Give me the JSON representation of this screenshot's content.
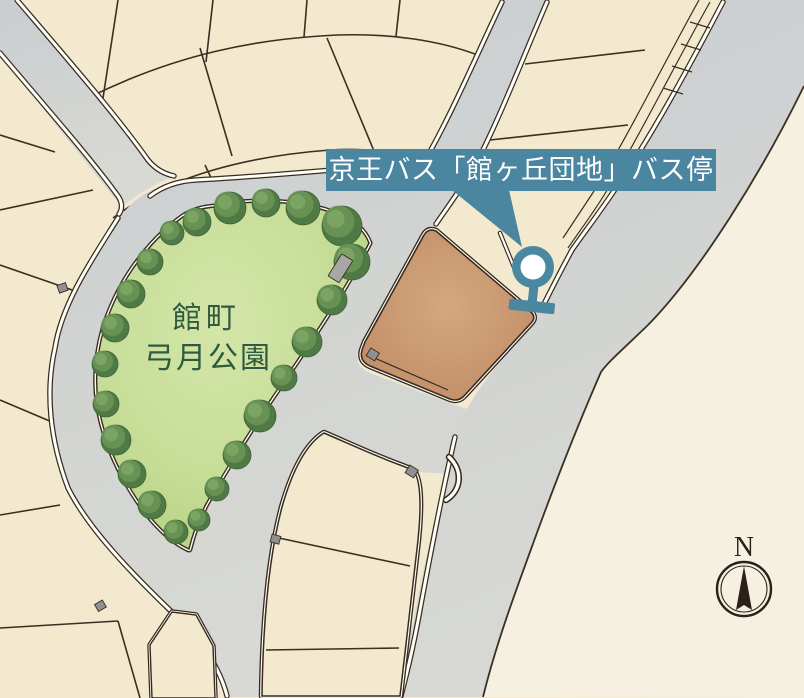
{
  "map": {
    "bus_stop_callout": {
      "label": "京王バス「館ヶ丘団地」バス停"
    },
    "park": {
      "name_line1": "館町",
      "name_line2": "弓月公園"
    },
    "compass": {
      "north_label": "N"
    },
    "colors": {
      "callout_teal": "#4a86a0",
      "pin_teal": "#4a87a1",
      "park_green_light": "#cfe3a3",
      "park_green_deep": "#b7d382",
      "tree_green": "#4f7a45",
      "lot_brown": "#c99a74",
      "road_gray": "#d1d3d2",
      "parcel_cream": "#f3e9ce",
      "background_cream": "#f6f0e1",
      "outline_ink": "#382c21",
      "park_label_green": "#2f5a40",
      "compass_ink": "#2b2118"
    }
  }
}
